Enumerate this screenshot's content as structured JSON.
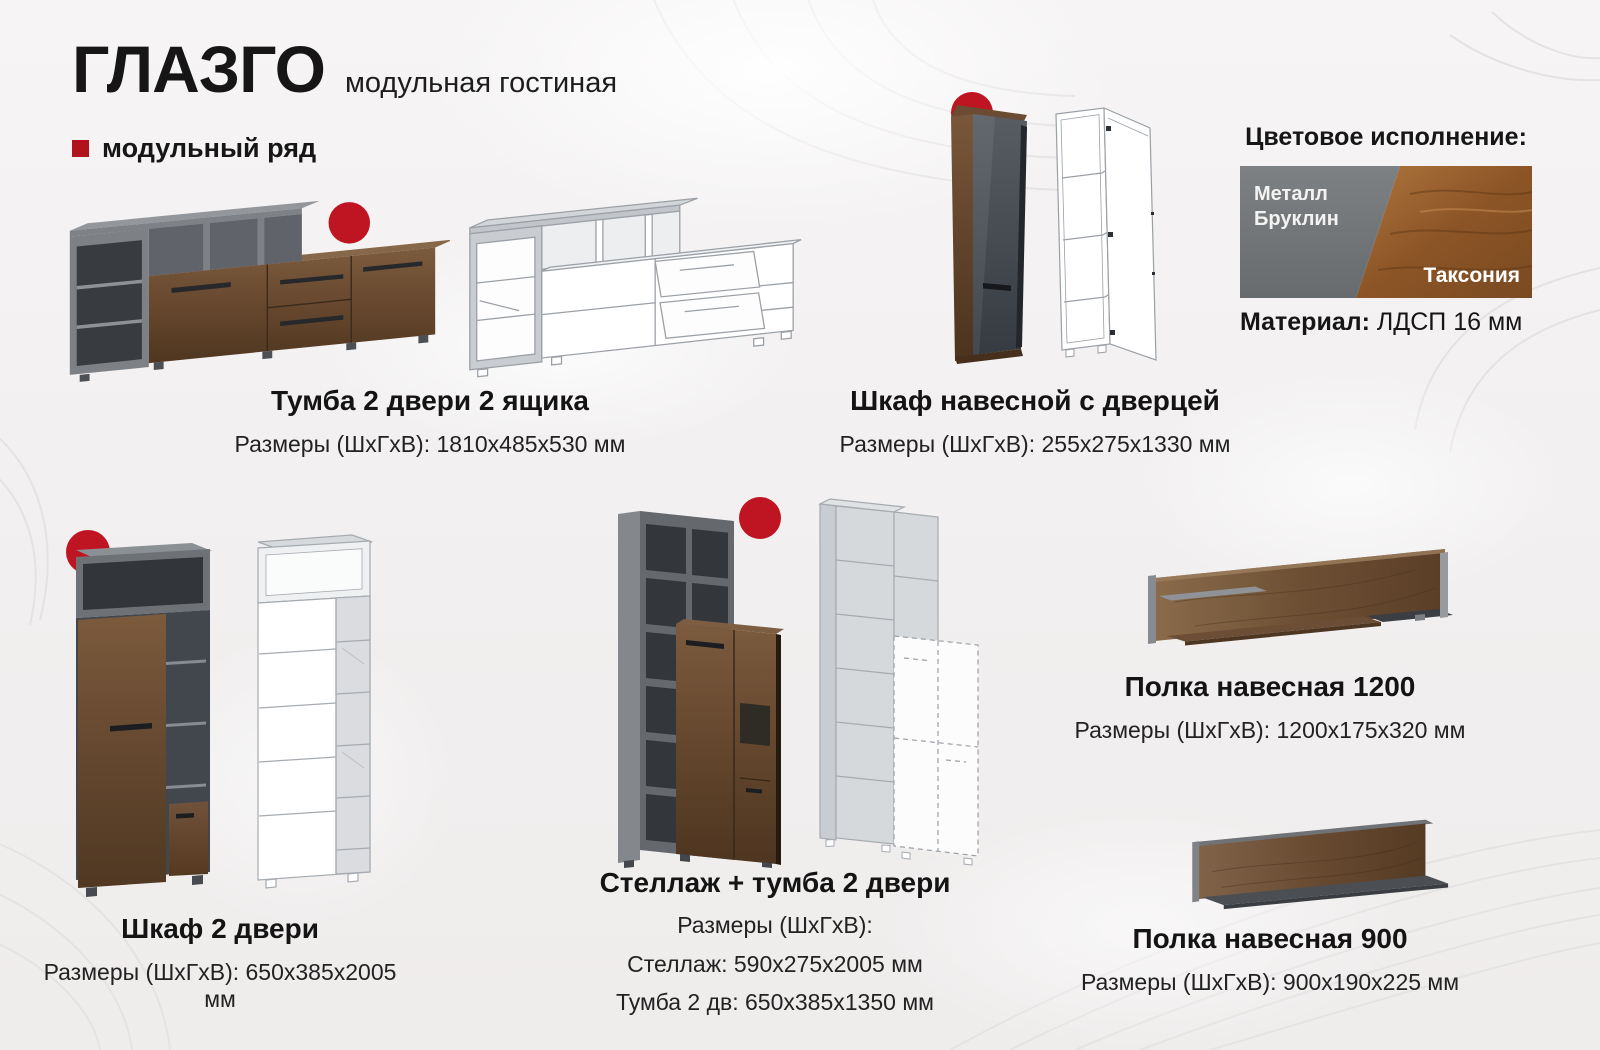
{
  "page": {
    "brand": "ГЛАЗГО",
    "subtitle": "модульная гостиная",
    "series_label": "модульный ряд"
  },
  "colors_panel": {
    "heading": "Цветовое исполнение:",
    "swatch_left": {
      "name": "Металл Бруклин",
      "color": "#75787b"
    },
    "swatch_right": {
      "name": "Таксония",
      "color": "#8a5527"
    },
    "material_label": "Материал:",
    "material_value": "ЛДСП 16 мм"
  },
  "accent": {
    "red_badge": "#bf1421",
    "red_bullet": "#b1121d"
  },
  "products": [
    {
      "name": "Тумба 2 двери 2 ящика",
      "size": "Размеры (ШхГхВ): 1810х485х530 мм"
    },
    {
      "name": "Шкаф навесной с дверцей",
      "size": "Размеры (ШхГхВ): 255х275х1330 мм"
    },
    {
      "name": "Шкаф 2 двери",
      "size": "Размеры (ШхГхВ): 650х385х2005 мм"
    },
    {
      "name": "Стеллаж + тумба 2 двери",
      "size": "Размеры (ШхГхВ):",
      "size_line1": "Стеллаж: 590х275х2005 мм",
      "size_line2": "Тумба 2 дв: 650х385х1350 мм"
    },
    {
      "name": "Полка навесная 1200",
      "size": "Размеры (ШхГхВ): 1200х175х320 мм"
    },
    {
      "name": "Полка навесная 900",
      "size": "Размеры (ШхГхВ): 900х190х225 мм"
    }
  ]
}
